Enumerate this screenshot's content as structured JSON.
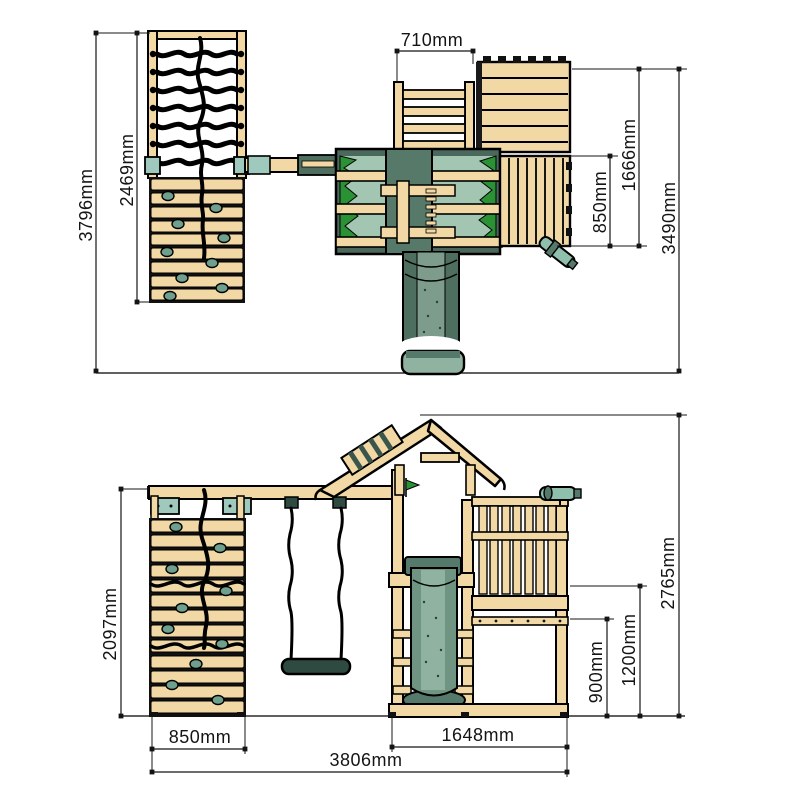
{
  "views": {
    "top": {
      "dim710": "710mm",
      "dim2469": "2469mm",
      "dim3796": "3796mm",
      "dim1666": "1666mm",
      "dim850": "850mm",
      "dim3490": "3490mm"
    },
    "front": {
      "dim2097": "2097mm",
      "dim850": "850mm",
      "dim3806": "3806mm",
      "dim1648": "1648mm",
      "dim900": "900mm",
      "dim1200": "1200mm",
      "dim2765": "2765mm"
    }
  },
  "colors": {
    "wood": "#f2d8a4",
    "outline": "#000000",
    "green_bright": "#2a9235",
    "sage_light": "#a3c6b2",
    "sage_mid": "#6f9482",
    "sage_dark": "#4e6e5f",
    "sage_deep": "#3a564c",
    "teal_bracket": "#9fc9bd",
    "dimension_text": "#141414"
  }
}
